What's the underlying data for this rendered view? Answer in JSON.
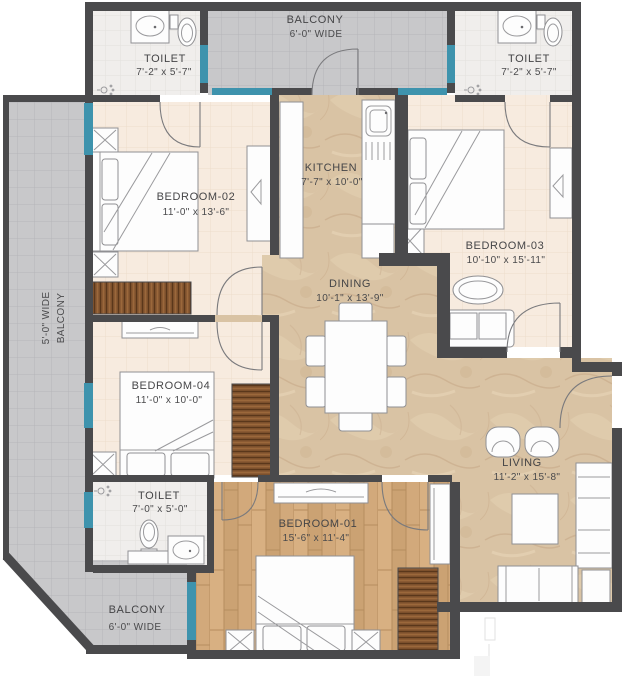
{
  "plan": {
    "title": "apartment-floor-plan",
    "rooms": {
      "toilet_top_left": {
        "name": "TOILET",
        "dims": "7'-2\" x 5'-7\""
      },
      "balcony_top": {
        "name": "BALCONY",
        "dims": "6'-0\" WIDE"
      },
      "toilet_top_right": {
        "name": "TOILET",
        "dims": "7'-2\" x 5'-7\""
      },
      "bedroom_02": {
        "name": "BEDROOM-02",
        "dims": "11'-0\" x 13'-6\""
      },
      "kitchen": {
        "name": "KITCHEN",
        "dims": "7'-7\" x 10'-0\""
      },
      "bedroom_03": {
        "name": "BEDROOM-03",
        "dims": "10'-10\" x 15'-11\""
      },
      "dining": {
        "name": "DINING",
        "dims": "10'-1\" x 13'-9\""
      },
      "bedroom_04": {
        "name": "BEDROOM-04",
        "dims": "11'-0\" x 10'-0\""
      },
      "balcony_left": {
        "name": "BALCONY",
        "dims": "5'-0\" WIDE"
      },
      "toilet_bottom": {
        "name": "TOILET",
        "dims": "7'-0\" x 5'-0\""
      },
      "bedroom_01": {
        "name": "BEDROOM-01",
        "dims": "15'-6\" x 11'-4\""
      },
      "balcony_bottom": {
        "name": "BALCONY",
        "dims": "6'-0\" WIDE"
      },
      "living": {
        "name": "LIVING",
        "dims": "11'-2\" x 15'-8\""
      }
    },
    "colors": {
      "wall": "#4a4a4c",
      "window": "#3e93ad",
      "balcony_floor": "#c8c8ca",
      "toilet_floor": "#f0eeec",
      "bedroom_floor": "#f7ebdf",
      "marble_floor": "#d9c3a4",
      "wood_floor": "#d2a97b",
      "wardrobe": "#8a5a33",
      "text": "#48484a"
    }
  }
}
